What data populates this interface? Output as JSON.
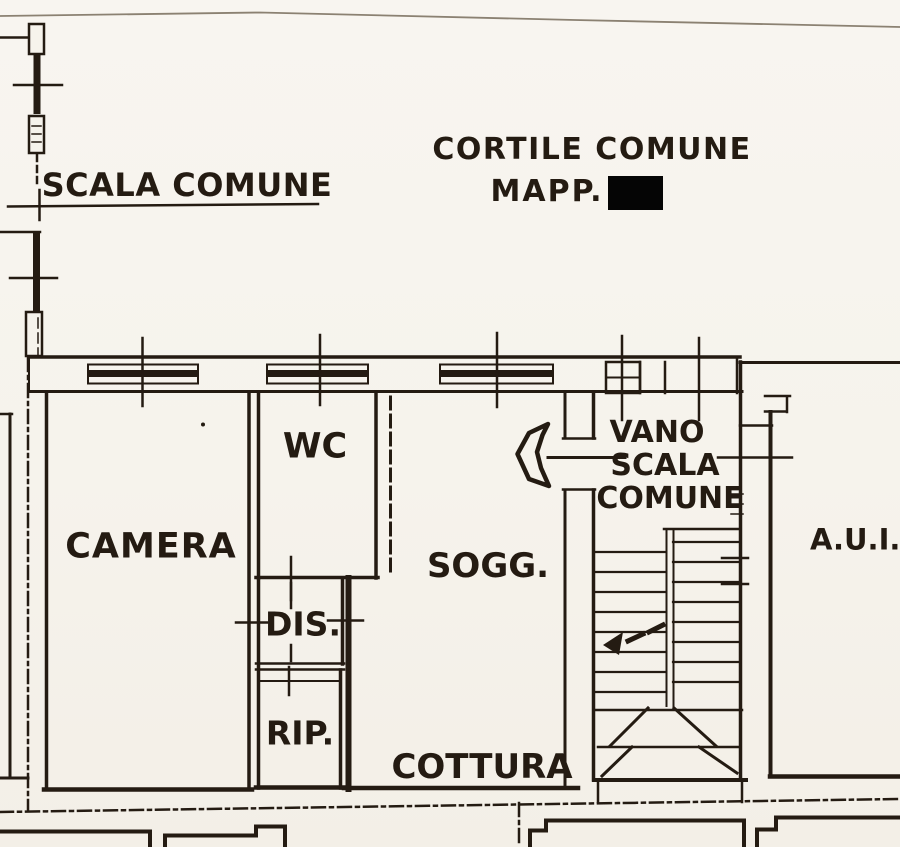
{
  "document": {
    "kind": "floor-plan drawing",
    "colors": {
      "paper": "#f6f3ec",
      "ink": "#241b12",
      "redaction": "#050505",
      "scan_edge_line": "#8b8172"
    }
  },
  "annotations": {
    "courtyard_label": "CORTILE COMUNE",
    "map_label": "MAPP.",
    "stair_label_top": "SCALA COMUNE"
  },
  "rooms": {
    "camera": {
      "label": "CAMERA"
    },
    "wc": {
      "label": "WC"
    },
    "dis": {
      "label": "DIS."
    },
    "rip": {
      "label": "RIP."
    },
    "sogg": {
      "label": "SOGG."
    },
    "cottura": {
      "label": "COTTURA"
    },
    "vano_scala": {
      "line1": "VANO",
      "line2": "SCALA",
      "line3": "COMUNE"
    },
    "auil": {
      "label": "A.U.I.L"
    }
  },
  "icons": {
    "entrance_arrow": "entry direction arrow",
    "stair_direction_arrow": "dashed up-direction arrow"
  }
}
